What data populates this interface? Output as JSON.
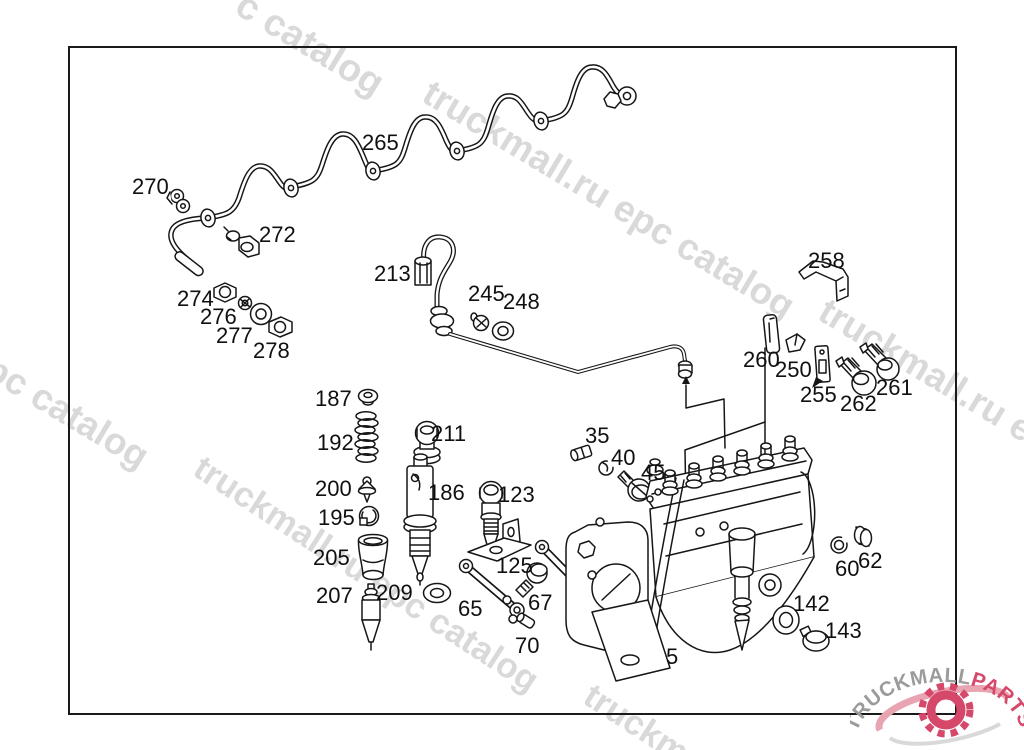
{
  "canvas": {
    "width": 1024,
    "height": 750,
    "background": "#ffffff"
  },
  "border": {
    "x": 68,
    "y": 46,
    "width": 889,
    "height": 669,
    "color": "#1a1a1a"
  },
  "watermarks": {
    "color": "#d9d9d9",
    "items": [
      {
        "text": "c catalog",
        "x": 250,
        "y": -16,
        "rot": 31,
        "size": 38
      },
      {
        "text": "truckmall.ru epc catalog",
        "x": 437,
        "y": 72,
        "rot": 31,
        "size": 37
      },
      {
        "text": "truckmall.ru e",
        "x": 833,
        "y": 290,
        "rot": 31,
        "size": 37
      },
      {
        "text": "l epc catalog",
        "x": -36,
        "y": 326,
        "rot": 31,
        "size": 37
      },
      {
        "text": "truckmall.ru epc catalog",
        "x": 208,
        "y": 448,
        "rot": 33,
        "size": 35
      },
      {
        "text": "truckm",
        "x": 598,
        "y": 676,
        "rot": 33,
        "size": 35
      }
    ]
  },
  "labels": {
    "font_size": 22,
    "color": "#101010",
    "items": [
      {
        "text": "265",
        "x": 362,
        "y": 132
      },
      {
        "text": "270",
        "x": 132,
        "y": 176
      },
      {
        "text": "272",
        "x": 259,
        "y": 224
      },
      {
        "text": "274",
        "x": 177,
        "y": 288
      },
      {
        "text": "276",
        "x": 200,
        "y": 306
      },
      {
        "text": "277",
        "x": 216,
        "y": 325
      },
      {
        "text": "278",
        "x": 253,
        "y": 340
      },
      {
        "text": "213",
        "x": 374,
        "y": 263
      },
      {
        "text": "245",
        "x": 468,
        "y": 283
      },
      {
        "text": "248",
        "x": 503,
        "y": 291
      },
      {
        "text": "258",
        "x": 808,
        "y": 250
      },
      {
        "text": "260",
        "x": 743,
        "y": 349
      },
      {
        "text": "250",
        "x": 775,
        "y": 359
      },
      {
        "text": "255",
        "x": 800,
        "y": 384
      },
      {
        "text": "261",
        "x": 876,
        "y": 377
      },
      {
        "text": "262",
        "x": 840,
        "y": 393
      },
      {
        "text": "187",
        "x": 315,
        "y": 388
      },
      {
        "text": "192",
        "x": 317,
        "y": 432
      },
      {
        "text": "200",
        "x": 315,
        "y": 478
      },
      {
        "text": "195",
        "x": 318,
        "y": 507
      },
      {
        "text": "205",
        "x": 313,
        "y": 547
      },
      {
        "text": "207",
        "x": 316,
        "y": 585
      },
      {
        "text": "209",
        "x": 376,
        "y": 582
      },
      {
        "text": "211",
        "x": 431,
        "y": 423
      },
      {
        "text": "186",
        "x": 428,
        "y": 482
      },
      {
        "text": "123",
        "x": 498,
        "y": 484
      },
      {
        "text": "125",
        "x": 496,
        "y": 555
      },
      {
        "text": "35",
        "x": 585,
        "y": 425
      },
      {
        "text": "40",
        "x": 611,
        "y": 447
      },
      {
        "text": "45",
        "x": 641,
        "y": 462
      },
      {
        "text": "65",
        "x": 458,
        "y": 598
      },
      {
        "text": "67",
        "x": 528,
        "y": 592
      },
      {
        "text": "70",
        "x": 515,
        "y": 635
      },
      {
        "text": "5",
        "x": 666,
        "y": 646
      },
      {
        "text": "60",
        "x": 835,
        "y": 558
      },
      {
        "text": "62",
        "x": 858,
        "y": 550
      },
      {
        "text": "142",
        "x": 793,
        "y": 593
      },
      {
        "text": "143",
        "x": 825,
        "y": 620
      }
    ]
  },
  "logo": {
    "text_gray": "TRUCKMALL",
    "text_red": "PARTS",
    "gray": "#9b9b9b",
    "red": "#d5486a",
    "pink": "#e8a4b0",
    "light": "#d9d9d9"
  }
}
